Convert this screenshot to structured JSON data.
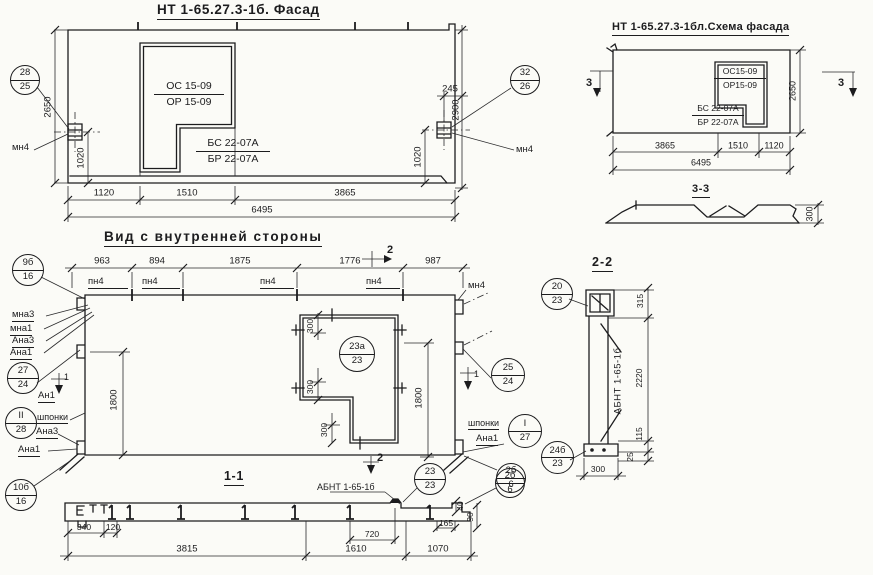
{
  "facade": {
    "title": "НТ 1-65.27.3-1б. Фасад",
    "window_label_top": "ОС 15-09",
    "window_label_bot": "ОР 15-09",
    "balcony_label_top": "БС 22-07А",
    "balcony_label_bot": "БР 22-07А",
    "callout_left_top": "28",
    "callout_left_bot": "25",
    "callout_right_top": "32",
    "callout_right_bot": "26",
    "anchor_left": "мн4",
    "anchor_right": "мн4",
    "dim_h_left": "2650",
    "dim_h_right": "2900",
    "dim_anchor_left": "1020",
    "dim_anchor_right": "1020",
    "dim_offset": "245",
    "dim_b1": "1120",
    "dim_b2": "1510",
    "dim_b3": "3865",
    "dim_total": "6495"
  },
  "schema": {
    "title": "НТ 1-65.27.3-1бл.Схема фасада",
    "window_label_top": "ОС15-09",
    "window_label_bot": "ОР15-09",
    "balcony_label_top": "БС 22-07А",
    "balcony_label_bot": "БР 22-07А",
    "dim_h": "2650",
    "dim_b1": "3865",
    "dim_b2": "1510",
    "dim_b3": "1120",
    "dim_total": "6495",
    "mark3_left": "3",
    "mark3_right": "3"
  },
  "section33": {
    "title": "3-3",
    "dim_300": "300"
  },
  "inner": {
    "title": "Вид с внутренней стороны",
    "dim_t1": "963",
    "dim_t2": "894",
    "dim_t3": "1875",
    "dim_t4": "1776",
    "dim_t5": "987",
    "pn1": "пн4",
    "pn2": "пн4",
    "pn3": "пн4",
    "pn4": "пн4",
    "mn4": "мн4",
    "mark2": "2",
    "mark1_left": "1",
    "mark1_right": "1",
    "co_9b_top": "9б",
    "co_9b_bot": "16",
    "lbl_mna3": "мна3",
    "lbl_mna1": "мна1",
    "lbl_ana3": "Ана3",
    "lbl_ana1": "Ана1",
    "co_27_top": "27",
    "co_27_bot": "24",
    "lbl_an1": "Ан1",
    "co_ii_top": "II",
    "co_ii_bot": "28",
    "lbl_shponki_l": "шпонки",
    "lbl_ana3_b": "Ана3",
    "lbl_ana1_b": "Ана1",
    "co_10b_top": "10б",
    "co_10b_bot": "16",
    "co_23a_top": "23а",
    "co_23a_bot": "23",
    "dim_1800_l": "1800",
    "dim_1800_r": "1800",
    "dim_300_a": "300",
    "dim_300_b": "300",
    "dim_300_c": "300",
    "co_25_top": "25",
    "co_25_bot": "24",
    "lbl_shponki_r": "шпонки",
    "co_i_top": "I",
    "co_i_bot": "27",
    "lbl_ana1_r": "Ана1",
    "co_2b_top": "2б",
    "co_2b_bot": "6"
  },
  "section11": {
    "title": "1-1",
    "mark2": "2",
    "lbl_abnt": "АБНТ 1-65-1б",
    "co_23_top": "23",
    "co_23_bot": "23",
    "co_2b_top": "2б",
    "co_2b_bot": "6",
    "dim_340": "340",
    "dim_120": "120",
    "dim_165": "165",
    "dim_40": "40",
    "dim_90": "90",
    "dim_720": "720",
    "dim_3815": "3815",
    "dim_1610": "1610",
    "dim_1070": "1070"
  },
  "section22": {
    "title": "2-2",
    "co_20_top": "20",
    "co_20_bot": "23",
    "co_24b_top": "24б",
    "co_24b_bot": "23",
    "lbl_abnt": "АБНТ 1-65-1б",
    "dim_315": "315",
    "dim_2220": "2220",
    "dim_115": "115",
    "dim_25": "25",
    "dim_300": "300"
  },
  "colors": {
    "ink": "#1c1c1e",
    "paper": "#fbfbf7"
  }
}
